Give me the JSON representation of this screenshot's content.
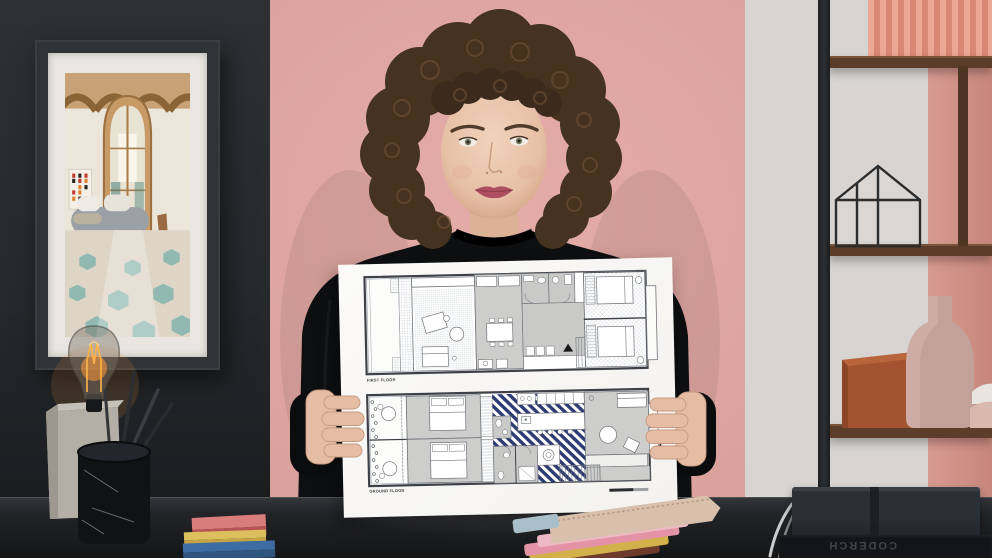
{
  "poster": {
    "first_floor_label": "FIRST FLOOR",
    "ground_floor_label": "GROUND FLOOR",
    "highlight_color": "#2e3a72",
    "paper_color": "#f8f7f5"
  },
  "books": {
    "spine_text": "CODERCH"
  },
  "palette": {
    "wall_left": "#2a2d30",
    "wall_pink": "#dfa7a2",
    "marble_panel": "#d7d4d1",
    "curtain_coral": "#e2988a",
    "shelf_wood": "#5b3d2a",
    "desk": "#1b1c1f",
    "sweater_black": "#0e0f11",
    "skin": "#e7c3ab",
    "hair_brown": "#4a3727",
    "lips": "#ad4f60",
    "terracotta_box": "#a3532f",
    "pink_vase": "#c2a19a",
    "bulb_glow": "#ffa94f",
    "sticky_note_colors": [
      "#cf6b6f",
      "#d8bc5a",
      "#3d6ca3"
    ]
  }
}
